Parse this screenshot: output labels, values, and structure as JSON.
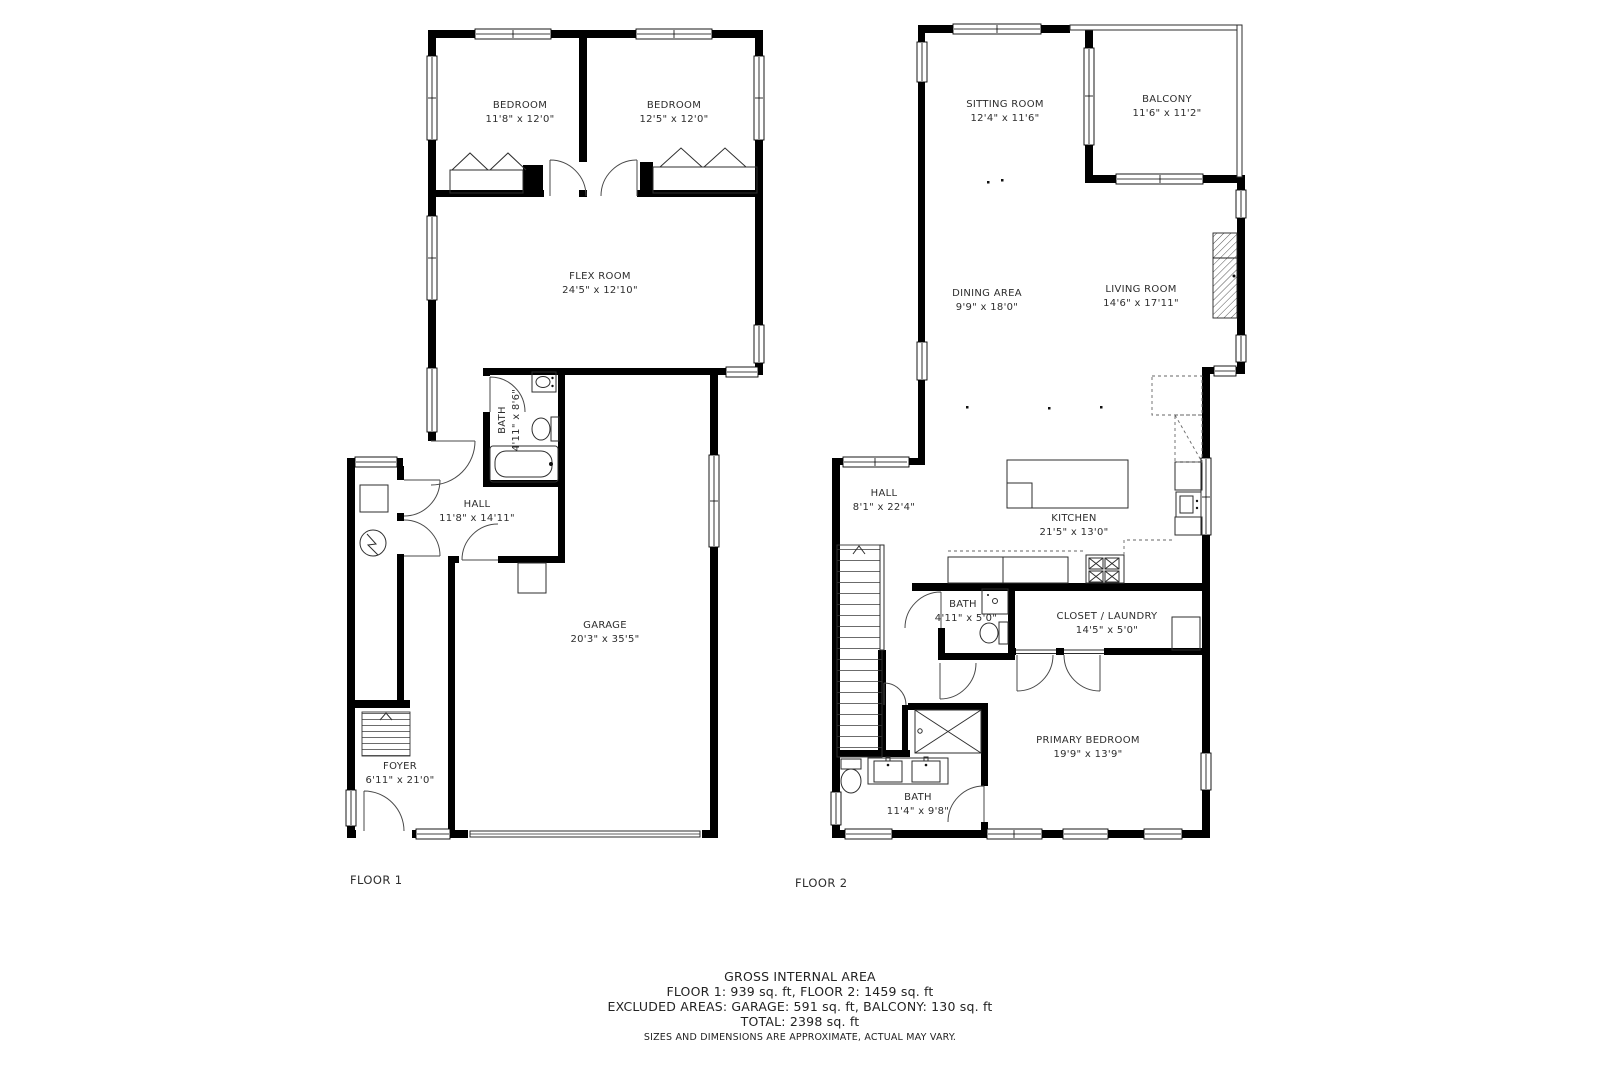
{
  "colors": {
    "wall": "#000000",
    "line": "#2e2e2e",
    "text": "#2d2d2d",
    "background": "#ffffff"
  },
  "floor1": {
    "label": "FLOOR 1",
    "rooms": {
      "bedroom1": {
        "name": "BEDROOM",
        "dims": "11'8\" x 12'0\""
      },
      "bedroom2": {
        "name": "BEDROOM",
        "dims": "12'5\" x 12'0\""
      },
      "flex": {
        "name": "FLEX ROOM",
        "dims": "24'5\" x 12'10\""
      },
      "bath": {
        "name": "BATH",
        "dims": "4'11\" x 8'6\""
      },
      "hall": {
        "name": "HALL",
        "dims": "11'8\" x 14'11\""
      },
      "garage": {
        "name": "GARAGE",
        "dims": "20'3\" x 35'5\""
      },
      "foyer": {
        "name": "FOYER",
        "dims": "6'11\" x 21'0\""
      }
    }
  },
  "floor2": {
    "label": "FLOOR 2",
    "rooms": {
      "sitting": {
        "name": "SITTING ROOM",
        "dims": "12'4\" x 11'6\""
      },
      "balcony": {
        "name": "BALCONY",
        "dims": "11'6\" x 11'2\""
      },
      "dining": {
        "name": "DINING AREA",
        "dims": "9'9\" x 18'0\""
      },
      "living": {
        "name": "LIVING ROOM",
        "dims": "14'6\" x 17'11\""
      },
      "hall": {
        "name": "HALL",
        "dims": "8'1\" x 22'4\""
      },
      "kitchen": {
        "name": "KITCHEN",
        "dims": "21'5\" x 13'0\""
      },
      "bath_small": {
        "name": "BATH",
        "dims": "4'11\" x 5'0\""
      },
      "closet_laundry": {
        "name": "CLOSET / LAUNDRY",
        "dims": "14'5\" x 5'0\""
      },
      "primary_bedroom": {
        "name": "PRIMARY BEDROOM",
        "dims": "19'9\" x 13'9\""
      },
      "bath_primary": {
        "name": "BATH",
        "dims": "11'4\" x 9'8\""
      }
    }
  },
  "summary": {
    "title": "GROSS INTERNAL AREA",
    "floors_line": "FLOOR 1: 939 sq. ft, FLOOR 2: 1459 sq. ft",
    "excluded_line": "EXCLUDED AREAS: GARAGE: 591 sq. ft, BALCONY: 130 sq. ft",
    "total_line": "TOTAL: 2398 sq. ft",
    "disclaimer": "SIZES AND DIMENSIONS ARE APPROXIMATE, ACTUAL MAY VARY."
  }
}
